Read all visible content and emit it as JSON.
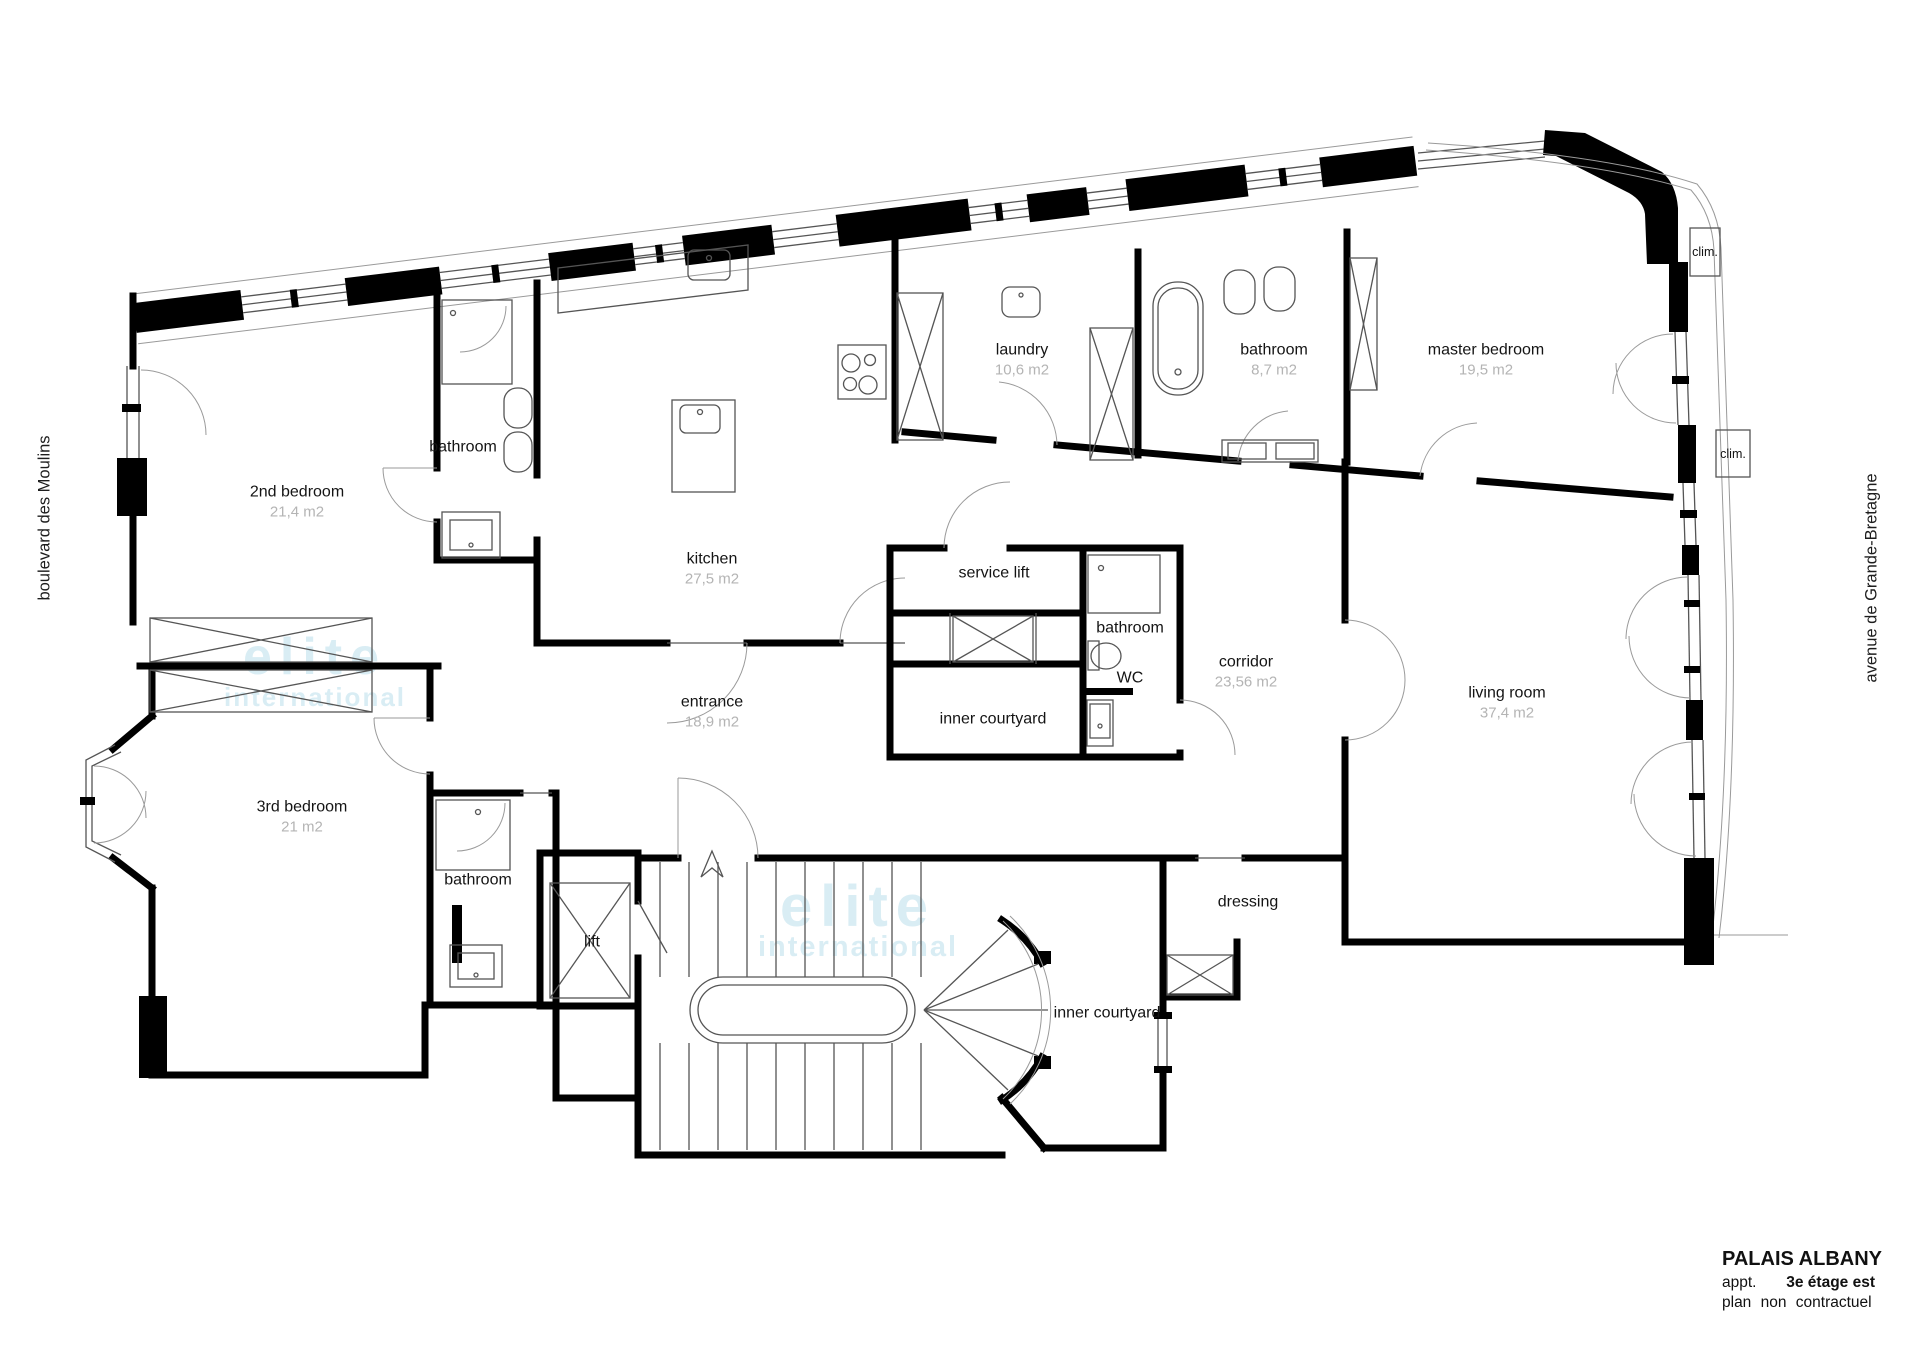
{
  "plan": {
    "streets": {
      "left": "boulevard des Moulins",
      "right": "avenue de Grande-Bretagne"
    },
    "climate_unit_label": "clim."
  },
  "rooms": {
    "second_bedroom": {
      "name": "2nd bedroom",
      "area": "21,4 m2"
    },
    "second_bathroom": {
      "name": "bathroom"
    },
    "kitchen": {
      "name": "kitchen",
      "area": "27,5 m2"
    },
    "laundry": {
      "name": "laundry",
      "area": "10,6 m2"
    },
    "main_bathroom": {
      "name": "bathroom",
      "area": "8,7 m2"
    },
    "master_bedroom": {
      "name": "master bedroom",
      "area": "19,5 m2"
    },
    "service_lift": {
      "name": "service lift"
    },
    "central_bathroom": {
      "name": "bathroom"
    },
    "wc": {
      "name": "WC"
    },
    "corridor": {
      "name": "corridor",
      "area": "23,56 m2"
    },
    "inner_courtyard_upper": {
      "name": "inner courtyard"
    },
    "entrance": {
      "name": "entrance",
      "area": "18,9 m2"
    },
    "living_room": {
      "name": "living room",
      "area": "37,4 m2"
    },
    "third_bedroom": {
      "name": "3rd bedroom",
      "area": "21 m2"
    },
    "third_bathroom": {
      "name": "bathroom"
    },
    "lift": {
      "name": "lift"
    },
    "dressing": {
      "name": "dressing"
    },
    "inner_courtyard_lower": {
      "name": "inner courtyard"
    }
  },
  "title_block": {
    "project": "PALAIS ALBANY",
    "line2_label": "appt.",
    "line2_value": "3e étage est",
    "line3": "plan non contractuel"
  },
  "watermark": {
    "line1": "elite",
    "line2": "international"
  }
}
